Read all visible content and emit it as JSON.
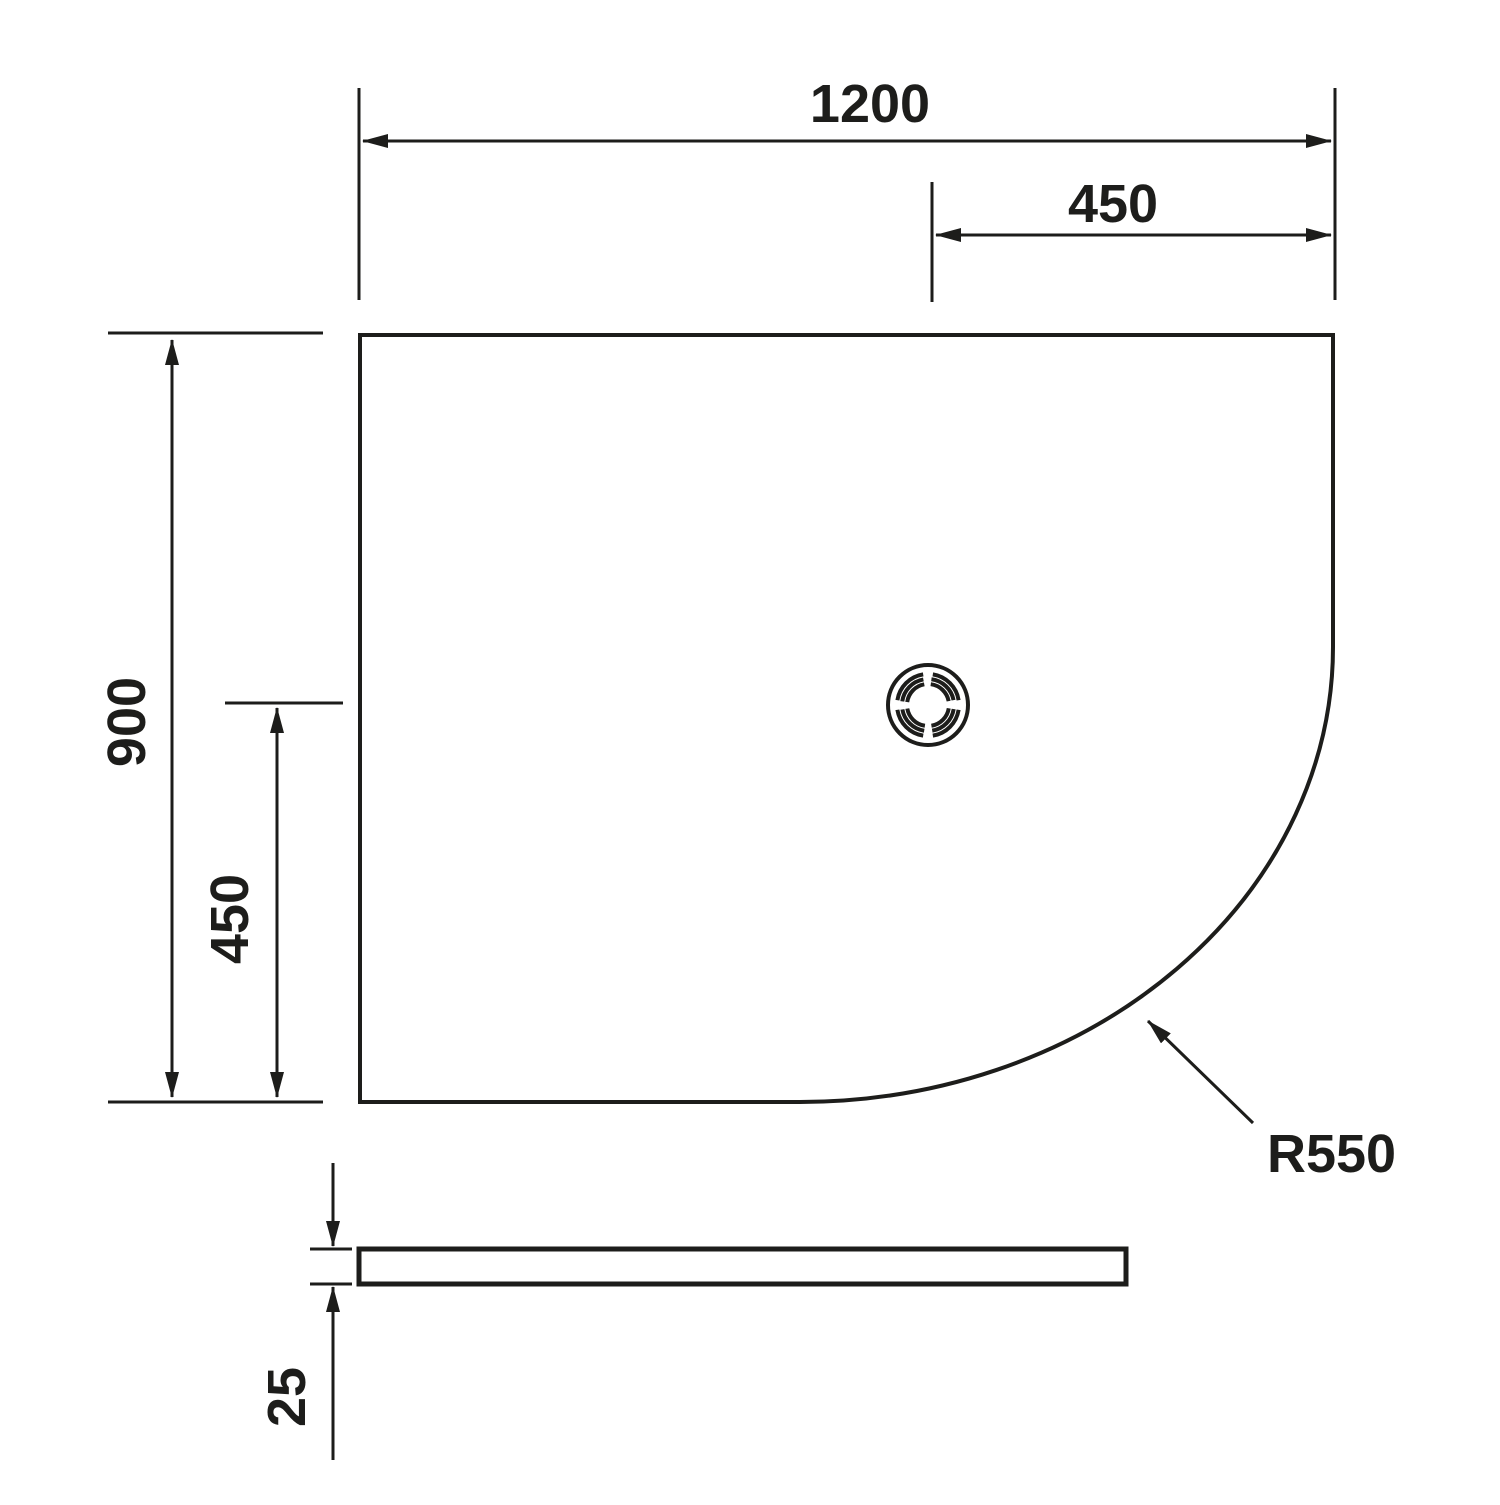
{
  "drawing": {
    "colors": {
      "background": "#ffffff",
      "line": "#1d1d1b"
    },
    "top_view": {
      "width_label": "1200",
      "width_offset_label": "450",
      "height_label": "900",
      "height_offset_label": "450",
      "radius_label": "R550"
    },
    "side_view": {
      "thickness_label": "25"
    }
  }
}
